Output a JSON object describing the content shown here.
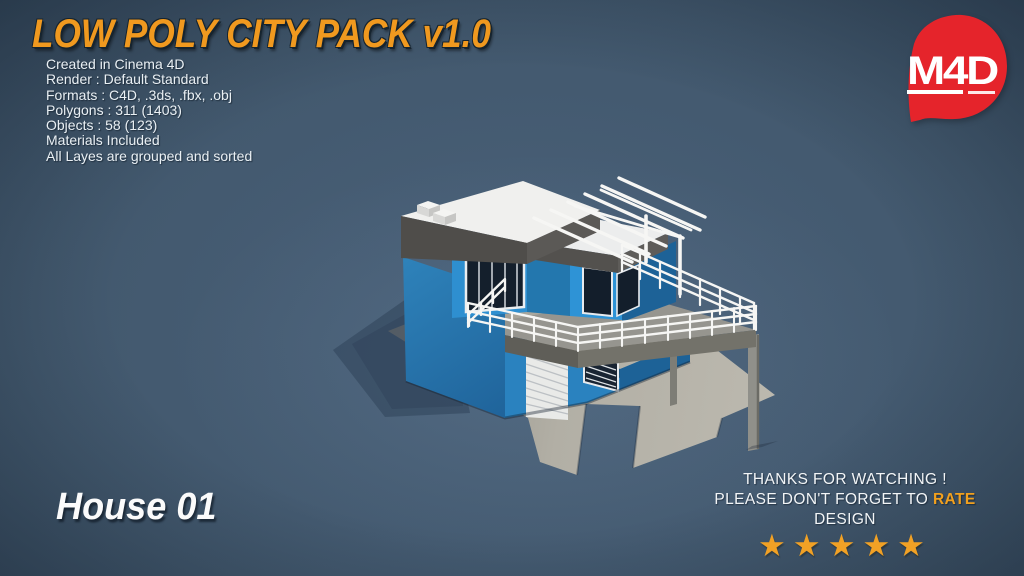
{
  "header": {
    "title": "LOW POLY CITY PACK v1.0",
    "specs": [
      "Created in Cinema 4D",
      "Render : Default Standard",
      "Formats : C4D, .3ds, .fbx, .obj",
      "Polygons : 311 (1403)",
      "Objects : 58 (123)",
      "Materials Included",
      "All Layes are grouped and sorted"
    ]
  },
  "logo": {
    "text": "M4D",
    "color": "#e5242b"
  },
  "model": {
    "label": "House 01"
  },
  "footer": {
    "line1": "THANKS FOR WATCHING !",
    "line2_prefix": "PLEASE DON'T FORGET TO ",
    "line2_highlight": "RATE",
    "line2_suffix": " DESIGN",
    "stars": "★★★★★",
    "star_count": 5
  },
  "scene": {
    "subject": "Low poly two-story blue house 3D render with roof terrace, pergola and balcony railing",
    "colors": {
      "background": "#42586d",
      "accent_orange": "#f0991f",
      "star_orange": "#f1a125",
      "logo_red": "#e5242b",
      "wall_blue_bright": "#2e92d6",
      "wall_blue_side": "#2a7ab2",
      "wall_blue_dark": "#1d6297",
      "roof_white": "#f0f0ee",
      "roof_fascia_gray": "#504e4b",
      "deck_gray": "#96958f",
      "ground_pad_gray": "#b4b1a7",
      "window_dark": "#141f2c",
      "railing_white": "#f6f6f4"
    }
  }
}
